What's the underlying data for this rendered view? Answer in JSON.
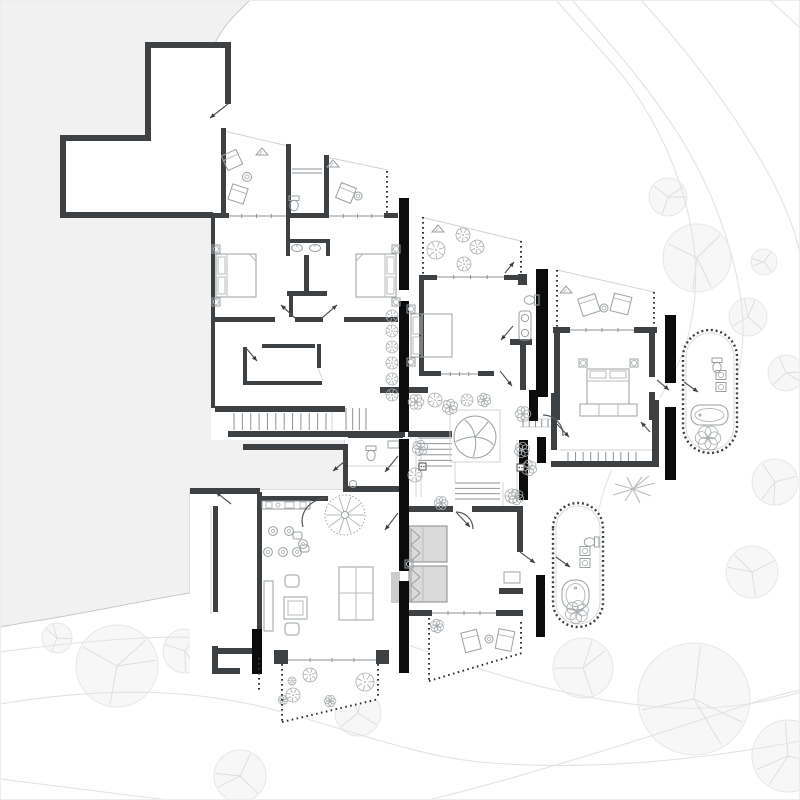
{
  "canvas": {
    "width": 800,
    "height": 800,
    "background": "#ffffff"
  },
  "palette": {
    "site": "#f1f1f2",
    "siteEdge": "#c9c9cc",
    "wall": "#3e4144",
    "black": "#0c0c0c",
    "thin": "#8f9295",
    "faint": "#cfd1d3",
    "furn": "#9aa0a3",
    "furn2": "#b9bcbe",
    "contour": "#e2e3e5",
    "treeF": "#f7f7f8",
    "treeE": "#e6e7e9",
    "treeB": "#dbdcde",
    "plant": "#a8adaf",
    "bedF": "#dadada",
    "counter": "#cacccd",
    "stip": "#333333"
  },
  "layers": {
    "site_path": "M0,0 L250,0 C238,12 221,27 214,46 L214,392 L228,392 L228,437 L345,437 L345,490 L190,490 L190,593 C152,599 96,611 42,620 C27,622 12,625 0,627 Z",
    "contours": [
      "M556,0 C592,42 620,68 641,102 C664,139 676,168 686,205 C697,246 699,287 690,328 C681,369 659,401 634,434 C615,459 605,481 599,509 C596,524 596,532 597,541",
      "M572,0 C616,50 652,92 682,140 C713,191 733,247 741,300 C748,352 737,394 713,424",
      "M641,0 C690,54 739,118 774,184 C789,214 797,238 800,254",
      "M770,0 C779,9 791,19 800,28",
      "M408,645 C440,656 475,668 520,681 C560,692 610,703 660,707 C710,711 760,705 800,692",
      "M0,652 C90,640 170,633 240,640 C285,644 330,655 372,668",
      "M0,704 C110,686 200,688 290,714 C360,734 420,756 480,762 C590,772 700,760 800,741",
      "M428,800 C520,778 640,740 740,707 C762,699 782,694 800,690",
      "M0,779 C60,786 120,794 168,800"
    ],
    "trees": [
      [
        668,
        197,
        19
      ],
      [
        697,
        258,
        34
      ],
      [
        764,
        262,
        13
      ],
      [
        748,
        317,
        19
      ],
      [
        786,
        373,
        18
      ],
      [
        775,
        482,
        23
      ],
      [
        752,
        572,
        26
      ],
      [
        583,
        668,
        30
      ],
      [
        694,
        699,
        56
      ],
      [
        788,
        756,
        36
      ],
      [
        57,
        638,
        15
      ],
      [
        117,
        666,
        41
      ],
      [
        185,
        651,
        22
      ],
      [
        240,
        776,
        26
      ],
      [
        358,
        713,
        23
      ]
    ],
    "floor_plates": [
      "M145,42 L231,42 L231,218 L60,218 L60,135 L145,135 Z",
      "M222,130 L290,146 L290,218 L222,218 Z",
      "M286,145 L330,145 L330,218 L286,218 Z",
      "M326,155 L390,170 L390,218 L326,218 Z",
      "M211,218 L409,218 L409,440 L211,440 Z",
      "M421,217 L521,241 L521,277 L421,277 Z",
      "M410,277 L547,277 L547,392 L410,392 Z",
      "M557,270 L657,292 L657,327 L557,327 Z",
      "M536,327 L660,327 L660,470 L536,470 Z",
      "M395,378 L557,378 L557,512 L395,512 Z",
      "M345,437 L410,437 L410,492 L345,492 Z",
      "M190,490 L410,490 L410,673 L190,673 Z",
      "M405,503 L547,503 L547,623 L405,623 Z",
      "M215,392 L409,392 L409,440 L215,440 Z",
      "M282,664 L378,664 L378,699 L282,722 Z",
      "M429,617 L522,617 L522,652 L429,680 Z"
    ],
    "walls": [
      [
        145,
        42,
        86,
        6
      ],
      [
        225,
        42,
        6,
        62
      ],
      [
        145,
        42,
        6,
        99
      ],
      [
        60,
        135,
        91,
        6
      ],
      [
        60,
        135,
        6,
        83
      ],
      [
        60,
        212,
        153,
        6
      ],
      [
        221,
        128,
        5,
        90
      ],
      [
        286,
        144,
        5,
        74
      ],
      [
        324,
        155,
        5,
        63
      ],
      [
        203,
        213,
        26,
        5
      ],
      [
        286,
        213,
        43,
        5
      ],
      [
        384,
        213,
        14,
        5
      ],
      [
        211,
        218,
        4,
        190
      ],
      [
        213,
        317,
        62,
        5
      ],
      [
        295,
        317,
        28,
        5
      ],
      [
        344,
        317,
        54,
        5
      ],
      [
        286,
        218,
        4,
        22
      ],
      [
        289,
        294,
        4,
        23
      ],
      [
        286,
        239,
        44,
        4
      ],
      [
        286,
        239,
        4,
        17
      ],
      [
        326,
        239,
        4,
        17
      ],
      [
        304,
        255,
        5,
        40
      ],
      [
        287,
        291,
        40,
        5
      ],
      [
        262,
        344,
        53,
        4
      ],
      [
        317,
        344,
        4,
        24
      ],
      [
        243,
        347,
        4,
        38
      ],
      [
        243,
        381,
        79,
        4
      ],
      [
        215,
        406,
        130,
        6
      ],
      [
        228,
        431,
        177,
        6
      ],
      [
        408,
        431,
        44,
        6
      ],
      [
        380,
        387,
        48,
        6
      ],
      [
        348,
        433,
        55,
        5
      ],
      [
        419,
        275,
        18,
        5
      ],
      [
        504,
        275,
        17,
        5
      ],
      [
        419,
        277,
        5,
        98
      ],
      [
        419,
        371,
        22,
        5
      ],
      [
        478,
        371,
        16,
        5
      ],
      [
        518,
        274,
        9,
        11
      ],
      [
        510,
        339,
        22,
        6
      ],
      [
        520,
        345,
        6,
        45
      ],
      [
        553,
        327,
        17,
        6
      ],
      [
        634,
        327,
        23,
        6
      ],
      [
        554,
        327,
        6,
        93
      ],
      [
        649,
        327,
        6,
        50
      ],
      [
        649,
        392,
        6,
        28
      ],
      [
        551,
        393,
        6,
        57
      ],
      [
        551,
        461,
        108,
        6
      ],
      [
        652,
        400,
        7,
        67
      ],
      [
        243,
        444,
        102,
        6
      ],
      [
        190,
        488,
        70,
        6
      ],
      [
        343,
        444,
        5,
        46
      ],
      [
        343,
        486,
        60,
        6
      ],
      [
        213,
        506,
        5,
        106
      ],
      [
        257,
        492,
        5,
        140
      ],
      [
        262,
        496,
        66,
        5
      ],
      [
        218,
        648,
        44,
        6
      ],
      [
        274,
        650,
        14,
        14
      ],
      [
        376,
        650,
        13,
        14
      ],
      [
        212,
        646,
        6,
        28
      ],
      [
        212,
        668,
        28,
        6
      ],
      [
        408,
        506,
        45,
        6
      ],
      [
        472,
        506,
        50,
        6
      ],
      [
        517,
        506,
        6,
        46
      ],
      [
        499,
        588,
        24,
        6
      ],
      [
        408,
        610,
        24,
        6
      ],
      [
        496,
        610,
        27,
        6
      ],
      [
        700,
        353,
        33,
        5
      ],
      [
        573,
        527,
        28,
        5
      ]
    ],
    "accent_bars": [
      [
        399,
        198,
        10,
        92
      ],
      [
        399,
        301,
        10,
        131
      ],
      [
        399,
        439,
        10,
        132
      ],
      [
        399,
        581,
        10,
        92
      ],
      [
        536,
        269,
        12,
        128
      ],
      [
        529,
        390,
        9,
        31
      ],
      [
        537,
        437,
        9,
        26
      ],
      [
        519,
        440,
        9,
        60
      ],
      [
        536,
        575,
        9,
        62
      ],
      [
        665,
        315,
        11,
        68
      ],
      [
        665,
        407,
        11,
        73
      ],
      [
        252,
        629,
        10,
        45
      ]
    ],
    "rails": [
      [
        387,
        171,
        387,
        217
      ],
      [
        423,
        217,
        423,
        277
      ],
      [
        521,
        241,
        521,
        275
      ],
      [
        557,
        270,
        557,
        327
      ],
      [
        654,
        292,
        654,
        327
      ],
      [
        429,
        618,
        429,
        681
      ],
      [
        429,
        681,
        522,
        653
      ],
      [
        521,
        622,
        521,
        652
      ],
      [
        282,
        664,
        282,
        722
      ],
      [
        282,
        722,
        379,
        699
      ],
      [
        378,
        664,
        378,
        699
      ],
      [
        259,
        658,
        259,
        692
      ]
    ],
    "thin_lines": [
      [
        224,
        131,
        288,
        146
      ],
      [
        326,
        157,
        388,
        170
      ],
      [
        421,
        217,
        521,
        241
      ],
      [
        557,
        270,
        654,
        292
      ],
      [
        416,
        437,
        416,
        497
      ],
      [
        421,
        437,
        421,
        497
      ],
      [
        517,
        440,
        517,
        500
      ],
      [
        522,
        440,
        522,
        500
      ],
      [
        348,
        466,
        396,
        466
      ],
      [
        520,
        419,
        552,
        419
      ],
      [
        520,
        427,
        552,
        427
      ],
      [
        560,
        450,
        652,
        450
      ],
      [
        455,
        462,
        455,
        482
      ],
      [
        503,
        482,
        503,
        512
      ],
      [
        260,
        630,
        260,
        650
      ],
      [
        317,
        365,
        323,
        381
      ],
      [
        332,
        408,
        332,
        431
      ],
      [
        211,
        506,
        211,
        614
      ]
    ],
    "tread_runs": [
      {
        "o": "v",
        "a": 234,
        "b": 326,
        "n": 12,
        "c1": 413,
        "c2": 430
      },
      {
        "o": "v",
        "a": 346,
        "b": 366,
        "n": 4,
        "c1": 408,
        "c2": 430
      },
      {
        "o": "h",
        "a": 438,
        "b": 466,
        "n": 6,
        "c1": 418,
        "c2": 452
      },
      {
        "o": "h",
        "a": 483,
        "b": 499,
        "n": 4,
        "c1": 455,
        "c2": 500
      },
      {
        "o": "v",
        "a": 568,
        "b": 636,
        "n": 10,
        "c1": 452,
        "c2": 461
      },
      {
        "o": "v",
        "a": 523,
        "b": 548,
        "n": 5,
        "c1": 419,
        "c2": 427
      }
    ],
    "windows": [
      [
        227,
        216,
        286,
        216
      ],
      [
        329,
        216,
        386,
        216
      ],
      [
        437,
        277,
        504,
        277
      ],
      [
        570,
        330,
        634,
        330
      ],
      [
        441,
        374,
        478,
        374
      ],
      [
        428,
        509,
        453,
        509
      ],
      [
        472,
        509,
        517,
        509
      ],
      [
        432,
        613,
        496,
        613
      ],
      [
        288,
        660,
        376,
        660
      ]
    ],
    "door_leaves": [
      [
        228,
        104,
        210,
        118
      ],
      [
        295,
        318,
        281,
        305
      ],
      [
        322,
        318,
        337,
        305
      ],
      [
        246,
        348,
        257,
        361
      ],
      [
        500,
        371,
        512,
        386
      ],
      [
        513,
        326,
        501,
        340
      ],
      [
        505,
        273,
        514,
        262
      ],
      [
        657,
        380,
        669,
        390
      ],
      [
        684,
        382,
        698,
        392
      ],
      [
        650,
        432,
        641,
        422
      ],
      [
        557,
        424,
        569,
        437
      ],
      [
        398,
        456,
        385,
        472
      ],
      [
        398,
        513,
        385,
        530
      ],
      [
        231,
        504,
        216,
        492
      ],
      [
        520,
        552,
        535,
        563
      ],
      [
        556,
        557,
        570,
        567
      ],
      [
        345,
        461,
        333,
        471
      ],
      [
        456,
        512,
        470,
        527
      ]
    ],
    "door_arcs": [
      "M456,512 A17,17 0 0 1 473,529",
      "M543,415 A20,20 0 0 1 563,436",
      "M327,498 A26,23 0 0 0 303,527"
    ],
    "pods": [
      {
        "outer": "M683,357 A27,27 0 0 1 737,357 L737,426 A27,27 0 0 1 683,426 Z",
        "inner": "M686,357 A24,24 0 0 1 734,357 L734,426 A24,24 0 0 1 686,426 Z"
      },
      {
        "outer": "M553,528 A25,25 0 0 1 603,528 L603,602 A25,25 0 0 1 553,602 Z",
        "inner": "M556,528 A22,22 0 0 1 600,528 L600,602 A22,22 0 0 1 556,602 Z"
      }
    ],
    "shrubs": [
      [
        392,
        316,
        6
      ],
      [
        392,
        331,
        6
      ],
      [
        392,
        347,
        6
      ],
      [
        392,
        363,
        6
      ],
      [
        392,
        379,
        6
      ],
      [
        392,
        395,
        6
      ],
      [
        436,
        250,
        9
      ],
      [
        463,
        235,
        7
      ],
      [
        477,
        247,
        7
      ],
      [
        464,
        264,
        7
      ],
      [
        435,
        400,
        7
      ],
      [
        467,
        400,
        6
      ],
      [
        415,
        475,
        7
      ],
      [
        512,
        496,
        7
      ],
      [
        310,
        675,
        7
      ],
      [
        292,
        681,
        4
      ],
      [
        293,
        695,
        7
      ],
      [
        365,
        682,
        9
      ]
    ],
    "scrub": [
      [
        416,
        402,
        8
      ],
      [
        450,
        407,
        8
      ],
      [
        484,
        400,
        7
      ],
      [
        523,
        414,
        8
      ],
      [
        522,
        450,
        8
      ],
      [
        516,
        497,
        8
      ],
      [
        441,
        503,
        7
      ],
      [
        420,
        448,
        8
      ],
      [
        529,
        468,
        8
      ],
      [
        708,
        438,
        13
      ],
      [
        577,
        612,
        12
      ],
      [
        437,
        626,
        7
      ],
      [
        330,
        701,
        6
      ],
      [
        283,
        700,
        5
      ]
    ],
    "canopy_trees": [
      [
        475,
        437,
        21
      ]
    ],
    "spiral_stair": {
      "cx": 345,
      "cy": 515,
      "r": 20
    },
    "side_tables": [
      [
        212,
        245
      ],
      [
        212,
        298
      ],
      [
        392,
        245
      ],
      [
        392,
        298
      ],
      [
        407,
        305
      ],
      [
        407,
        358
      ],
      [
        579,
        359
      ],
      [
        630,
        359
      ],
      [
        405,
        560
      ]
    ],
    "toilets": [
      [
        294,
        206,
        0
      ],
      [
        529,
        300,
        90
      ],
      [
        371,
        456,
        0
      ],
      [
        717,
        368,
        0
      ],
      [
        589,
        542,
        90
      ]
    ],
    "sinks_square": [
      [
        721,
        375
      ],
      [
        721,
        387
      ],
      [
        585,
        551
      ],
      [
        585,
        563
      ]
    ],
    "sinks_oval": [
      [
        297,
        248
      ],
      [
        315,
        248
      ]
    ],
    "sinks_round": [
      [
        525,
        318
      ],
      [
        525,
        333
      ]
    ],
    "stools": [
      [
        273,
        531
      ],
      [
        289,
        531
      ],
      [
        303,
        544
      ],
      [
        268,
        552
      ],
      [
        283,
        552
      ],
      [
        297,
        552
      ]
    ],
    "round_tables": [
      [
        247,
        177,
        4.5
      ],
      [
        358,
        196,
        4
      ],
      [
        604,
        308,
        4
      ],
      [
        489,
        639,
        4
      ]
    ],
    "plant_pots": [
      [
        262,
        152
      ],
      [
        333,
        164
      ],
      [
        566,
        290
      ],
      [
        438,
        229
      ]
    ],
    "level_markers": [
      [
        419,
        463
      ],
      [
        517,
        464
      ]
    ]
  }
}
